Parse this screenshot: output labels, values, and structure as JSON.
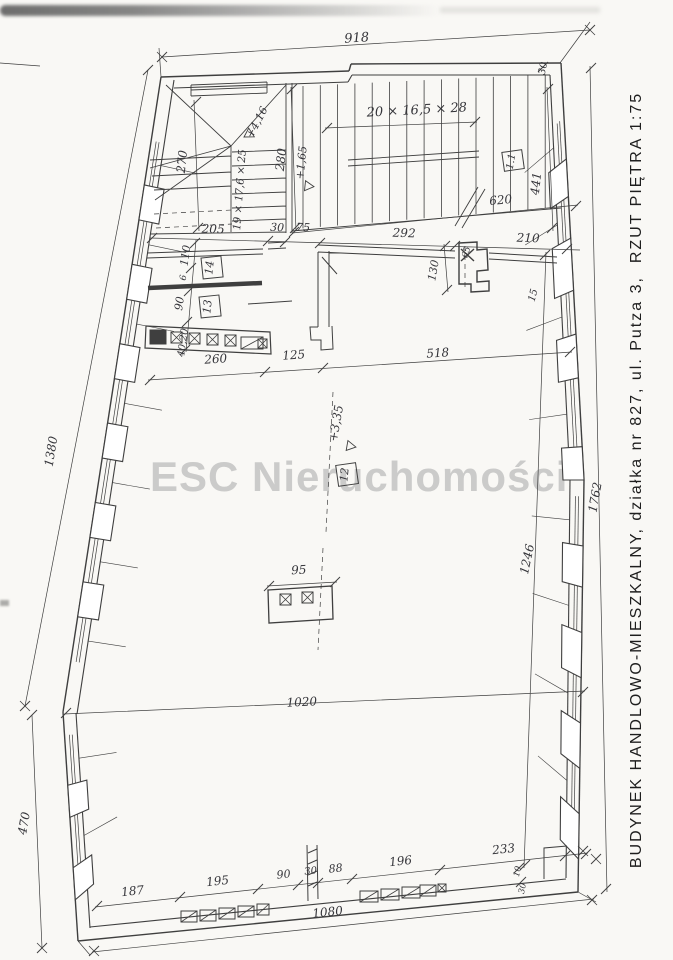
{
  "colors": {
    "ink": "#3f3f3f",
    "paper": "#f9f8f5",
    "watermark": "#cbcbca",
    "caption": "#1e1e1e"
  },
  "watermark": "ESC Nieruchomości",
  "side_caption": "BUDYNEK HANDLOWO-MIESZKALNY, działka nr 827, ul. Putza 3,  RZUT PIĘTRA 1:75",
  "stairs": {
    "main_run": "20 × 16,5 × 28",
    "winder_run": "19 × 17,6 × 25"
  },
  "levels": {
    "upper": "+4,16",
    "mid": "+1,65",
    "floor": "+3,35"
  },
  "rooms": {
    "hall": "1.1",
    "open": "12",
    "left_a": "14",
    "left_b": "13"
  },
  "dims": {
    "top": "918",
    "corner_30": "30",
    "left_upper": "1380",
    "left_lower": "470",
    "right_outer": "1762",
    "right_inner": "1246",
    "bottom_total": "1080",
    "hall_620": "620",
    "hall_441": "441",
    "stair_270": "270",
    "stair_280": "280",
    "corridor": [
      "205",
      "30",
      "75",
      "292",
      "210"
    ],
    "duct_130": "130",
    "duct_65": "65",
    "wall_15": "15",
    "leftcol": [
      "110",
      "6",
      "90",
      "40,20"
    ],
    "mid": [
      "260",
      "125",
      "518"
    ],
    "pillar_95": "95",
    "span_1020": "1020",
    "bottom": [
      "187",
      "195",
      "90",
      "30",
      "88",
      "196",
      "233"
    ],
    "step": [
      "10",
      "30"
    ]
  }
}
